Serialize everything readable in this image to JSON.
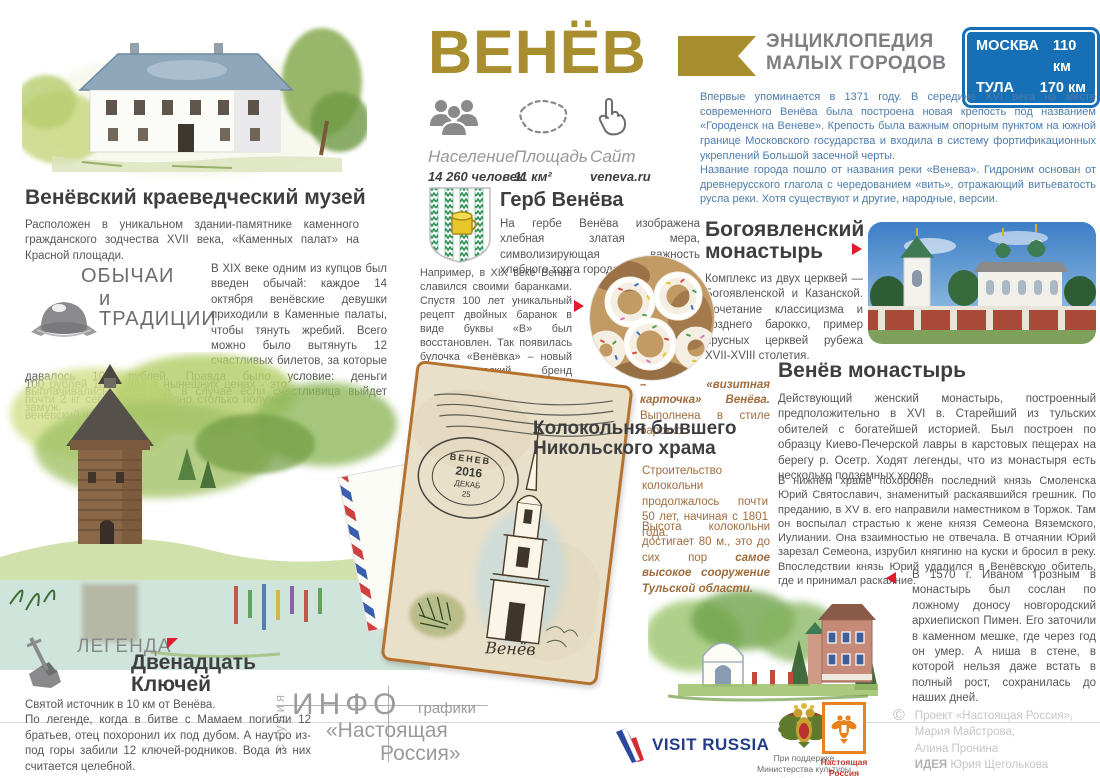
{
  "poster": {
    "title": "ВЕНЁВ",
    "series": {
      "line1": "ЭНЦИКЛОПЕДИЯ",
      "line2": "МАЛЫХ ГОРОДОВ"
    },
    "distance_sign": {
      "rows": [
        {
          "city": "МОСКВА",
          "distance": "110 км"
        },
        {
          "city": "ТУЛА",
          "distance": "170 км"
        }
      ]
    }
  },
  "stats": {
    "population": {
      "label": "Население",
      "value": "14 260 человек",
      "icon": "people-icon"
    },
    "area": {
      "label": "Площадь",
      "value": "11 км²",
      "icon": "territory-outline-icon"
    },
    "site": {
      "label": "Сайт",
      "value": "veneva.ru",
      "icon": "hand-cursor-icon"
    }
  },
  "history": {
    "p1": "Впервые упоминается в 1371 году. В середине XVI века на месте современного Венёва была построена новая крепость под названием «Городенск на Веневе». Крепость была важным опорным пунктом на южной границе Московского государства и входила в систему фортификационных укреплений Большой засечной черты.",
    "p2": "Название города пошло от названия реки «Венева». Гидроним основан от древнерусского глагола с чередованием «вить», отражающий витьеватость русла реки. Хотя существуют и другие, народные, версии."
  },
  "museum": {
    "title": "Венёвский краеведческий музей",
    "text": "Расположен в уникальном здании-памятнике каменного гражданского зодчества XVII века, «Каменных палат» на Красной площади."
  },
  "customs": {
    "label1": "ОБЫЧАИ",
    "label2": "и ТРАДИЦИИ",
    "p1": "В XIX веке одним из купцов был введен обычай: каждое 14 октября венёвские девушки приходили в Каменные палаты, чтобы тянуть жребий. Всего можно было вытянуть 12 счастливых билетов, за которые давалось 100 рублей. Правда было условие: деньги выплачивались через год, в случае если счастливица выйдет замуж.",
    "p2": "100 рублей 1853 года в нынешних ценах - это почти 2 кг серебра. Примерно столько получал венёвский чиновник за год."
  },
  "coat": {
    "title": "Герб Венёва",
    "text": "На гербе Венёва изображена хлебная златая мера, символизирующая важность хлебного торга города.",
    "baranki": "Например, в XIX веке Венёв славился своими баранками. Спустя 100 лет уникальный рецепт двойных баранок в виде буквы «В» был восстановлен. Так появилась булочка «Венёвка» – новый гастрономический бренд Тульской области."
  },
  "bogoyavlensky": {
    "title1": "Богоявленский",
    "title2": "монастырь",
    "text": "Комплекс из двух церквей — Богоявленской и Казанской. Сочетание классицизма и позднего барокко, пример ярусных церквей рубежа XVII-XVIII столетия."
  },
  "venev_monastery": {
    "title": "Венёв монастырь",
    "p1": "Действующий женский монастырь, построенный предположительно в XVI в. Старейший из тульских обителей с богатейшей историей. Был построен по образцу Киево-Печерской лавры в карстовых пещерах на берегу р. Осетр. Ходят легенды, что из монастыря есть несколько подземных ходов.",
    "p2": "В нижнем храме похоронен последний князь Смоленска Юрий Святославич, знаменитый раскаявшийся грешник. По преданию, в XV в. его направили наместником в Торжок. Там он воспылал страстью к жене князя Семеона Вяземского, Иулиании. Она взаимностью не отвечала. В отчаянии Юрий зарезал Семеона, изрубил княгиню на куски и бросил в реку. Впоследствии князь Юрий удалился в Венёвскую обитель, где и принимал раскаяние.",
    "p3": "В 1570 г. Иваном Грозным в монастырь был сослан по ложному доносу новгородский архиепископ Пимен. Его заточили в каменном мешке, где через год он умер. А ниша в стене, в которой нельзя даже встать в полный рост, сохранилась до наших дней."
  },
  "bell_tower": {
    "caption_bold": "– «визитная карточка» Венёва.",
    "caption_rest": " Выполнена в стиле барокко.",
    "title1": "Колокольня бывшего",
    "title2": "Никольского храма",
    "p1": "Строительство колокольни продолжалось почти 50 лет, начиная с 1801 года.",
    "p2_text": "Высота колокольни достигает 80 м., это до сих пор ",
    "p2_bold": "самое высокое сооружение Тульской области.",
    "postmark": {
      "city": "ВЕНЕВ",
      "year": "2016",
      "month": "ДЕКАБ",
      "day": "25"
    },
    "handwriting": "Венёв"
  },
  "legend": {
    "label": "ЛЕГЕНДА",
    "title1": "Двенадцать",
    "title2": "Ключей",
    "line1": "Святой источник в 10 км от Венёва.",
    "rest": "По легенде, когда в битве с Мамаем погибли 12 братьев, отец похоронил их под дубом. А наутро из-под горы забили 12 ключей-родников. Вода из них считается целебной."
  },
  "footer": {
    "studio_vertical": "студия",
    "logo_info": "ИНФО",
    "logo_grafiki": "графики",
    "logo_line2": "«Настоящая",
    "logo_line3": "Россия»",
    "visit_russia": "VISIT RUSSIA",
    "ministry1": "При поддержке",
    "ministry2": "Министерства культуры",
    "ministry3": "Российской Федерации",
    "stamp1": "Настоящая",
    "stamp2": "Россия",
    "copyright_symbol": "©",
    "copyright1": "Проект «Настоящая Россия»,",
    "copyright2": "Мария Майстрова,",
    "copyright3": "Алина Пронина",
    "idea_label": "ИДЕЯ",
    "idea_name": "Юрия Щеголькова"
  },
  "colors": {
    "gold": "#a98e2f",
    "heading": "#3e3e41",
    "body_gray": "#565659",
    "history_blue": "#4d7cac",
    "sign_blue": "#176fb5",
    "bell_tower_brown": "#a06c3c",
    "accent_red": "#e01b2c",
    "stamp_orange": "#e8821e"
  }
}
